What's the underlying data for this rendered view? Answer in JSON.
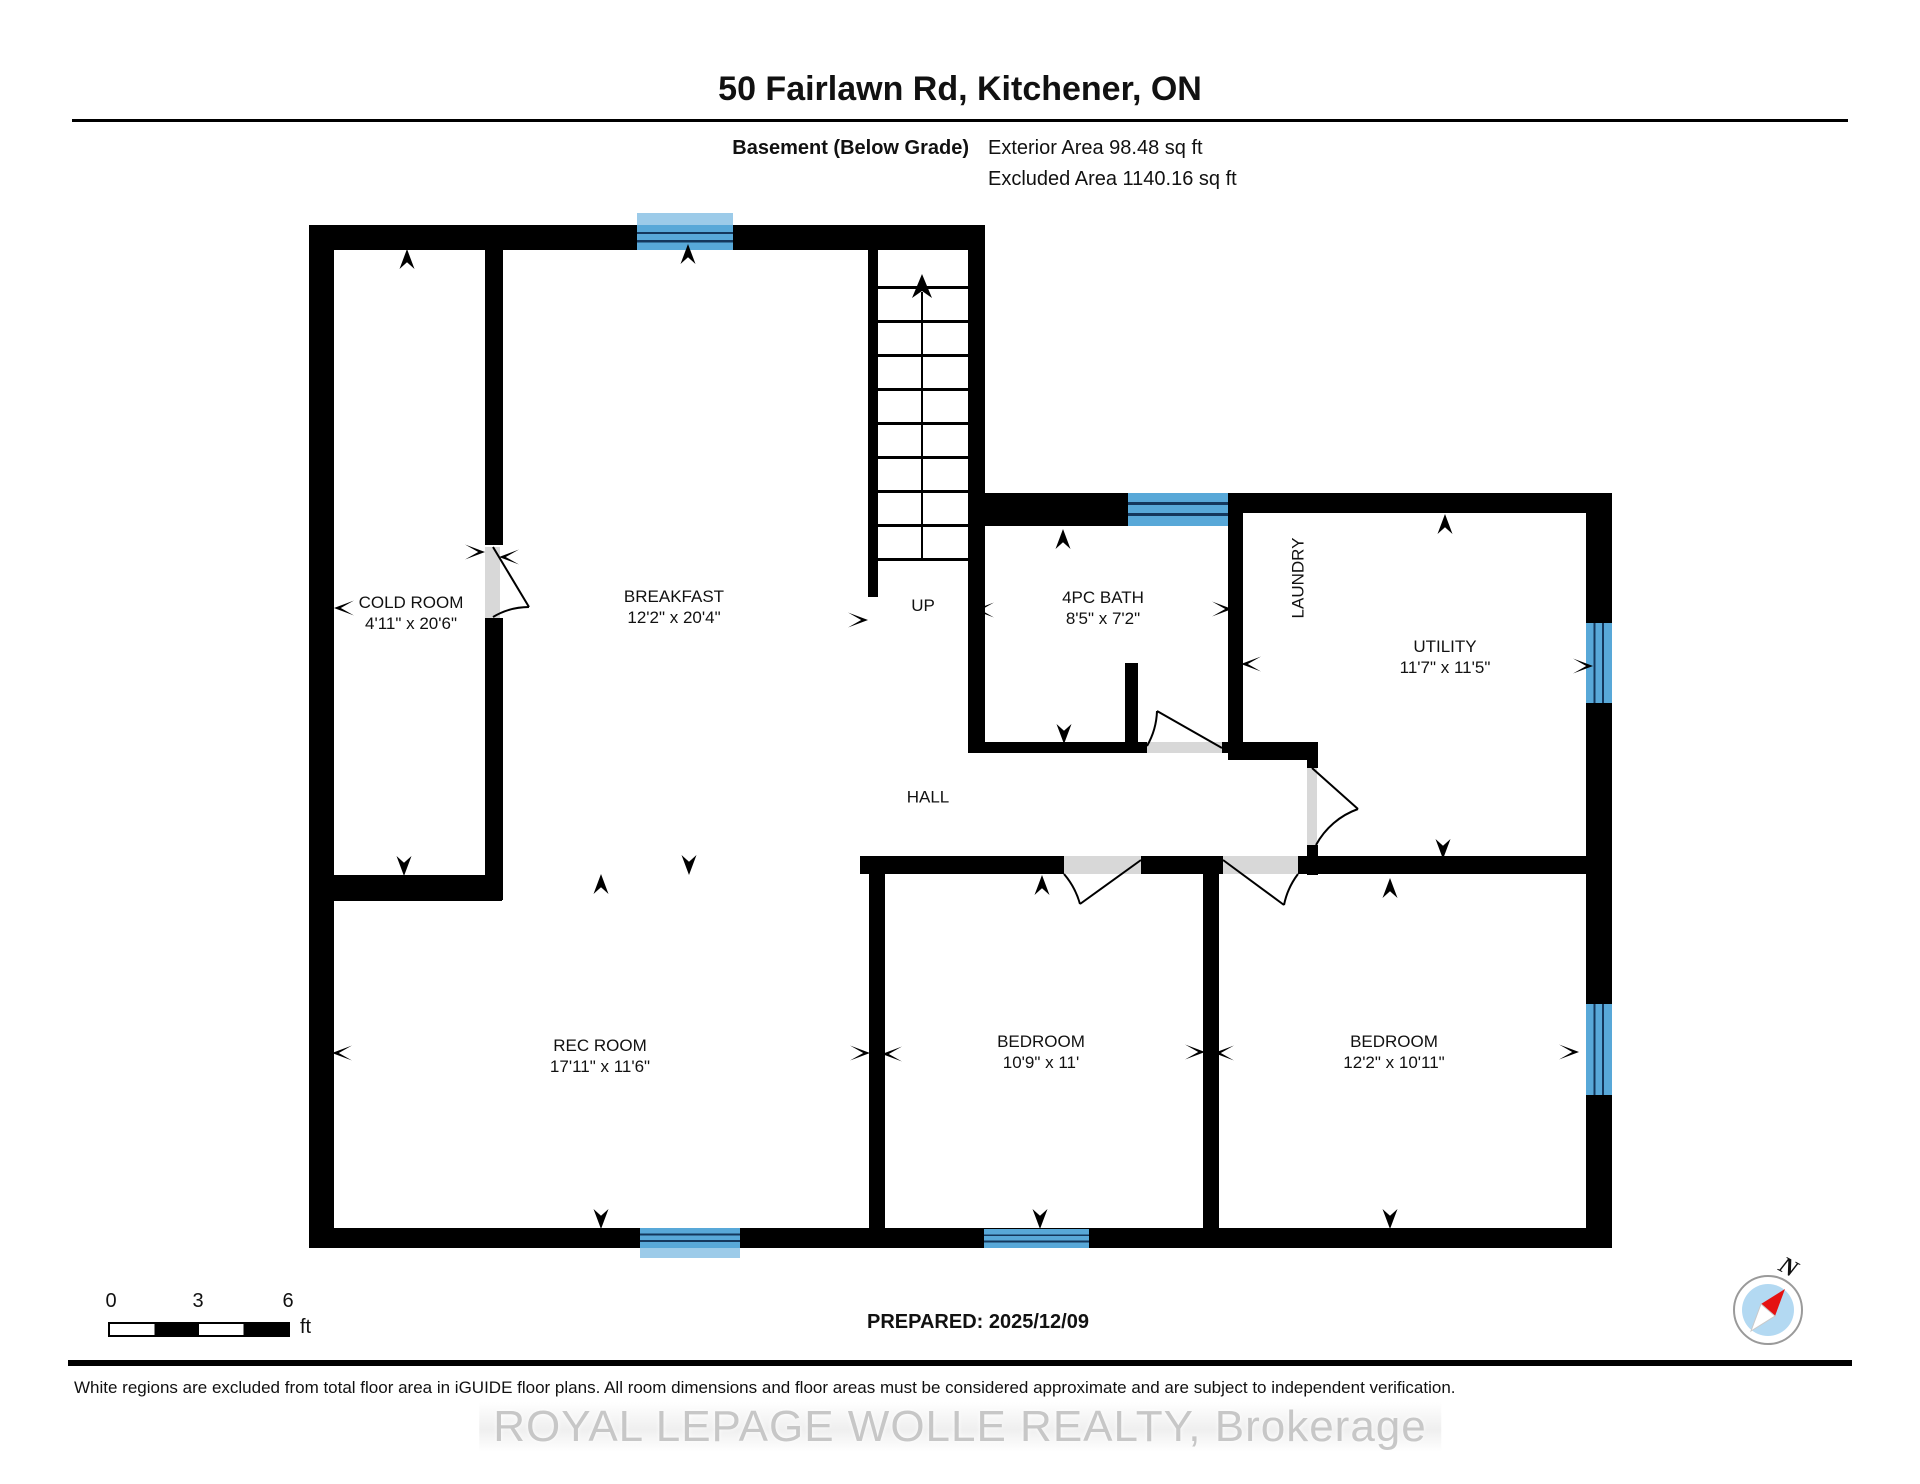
{
  "header": {
    "title": "50 Fairlawn Rd, Kitchener, ON",
    "floor_label": "Basement (Below Grade)",
    "exterior_area": "Exterior Area 98.48 sq ft",
    "excluded_area": "Excluded Area 1140.16 sq ft"
  },
  "rooms": [
    {
      "name": "COLD ROOM",
      "dims": "4'11\" x 20'6\""
    },
    {
      "name": "BREAKFAST",
      "dims": "12'2\" x 20'4\""
    },
    {
      "name": "4PC BATH",
      "dims": "8'5\" x 7'2\""
    },
    {
      "name": "LAUNDRY",
      "dims": ""
    },
    {
      "name": "UTILITY",
      "dims": "11'7\" x 11'5\""
    },
    {
      "name": "HALL",
      "dims": ""
    },
    {
      "name": "REC ROOM",
      "dims": "17'11\" x 11'6\""
    },
    {
      "name": "BEDROOM",
      "dims": "10'9\" x 11'"
    },
    {
      "name": "BEDROOM",
      "dims": "12'2\" x 10'11\""
    }
  ],
  "stairs": {
    "label": "UP"
  },
  "footer": {
    "scale": {
      "start": "0",
      "mid": "3",
      "end": "6",
      "unit": "ft"
    },
    "prepared": "PREPARED: 2025/12/09",
    "compass_label": "N",
    "disclaimer": "White regions are excluded from total floor area in iGUIDE floor plans. All room dimensions and floor areas must be considered approximate and are subject to independent verification.",
    "watermark": "ROYAL LEPAGE WOLLE REALTY, Brokerage"
  },
  "colors": {
    "wall": "#000000",
    "window": "#58a8d8",
    "door": "#d8d8d8",
    "compass_red": "#e51212",
    "compass_blue": "#b3d9f2",
    "watermark_gray": "#c7c7c7"
  }
}
